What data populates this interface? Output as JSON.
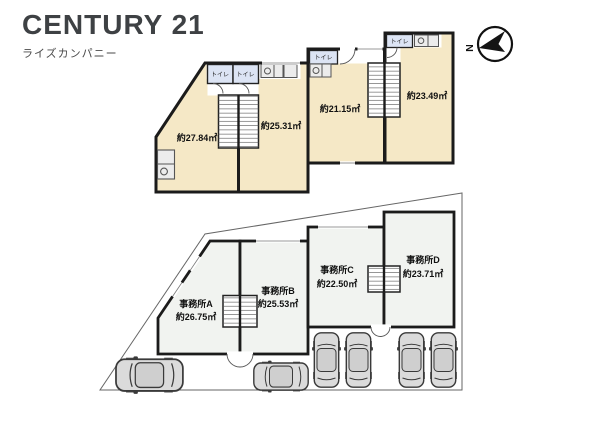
{
  "brand": {
    "logo": "CENTURY 21",
    "subtitle": "ライズカンパニー"
  },
  "compass": {
    "north_label": "N"
  },
  "upper_floor": {
    "toilet_labels": [
      "トイレ",
      "トイレ",
      "トイレ",
      "トイレ"
    ],
    "rooms": [
      {
        "area": "約27.84㎡"
      },
      {
        "area": "約25.31㎡"
      },
      {
        "area": "約21.15㎡"
      },
      {
        "area": "約23.49㎡"
      }
    ]
  },
  "lower_floor": {
    "offices": [
      {
        "name": "事務所A",
        "area": "約26.75㎡"
      },
      {
        "name": "事務所B",
        "area": "約25.53㎡"
      },
      {
        "name": "事務所C",
        "area": "約22.50㎡"
      },
      {
        "name": "事務所D",
        "area": "約23.71㎡"
      }
    ]
  },
  "colors": {
    "room_upper": "#f5e8c6",
    "room_lower": "#f1f3f0",
    "toilet": "#dce4f4",
    "wall": "#1b1b1b",
    "car": "#dbdbdb"
  }
}
